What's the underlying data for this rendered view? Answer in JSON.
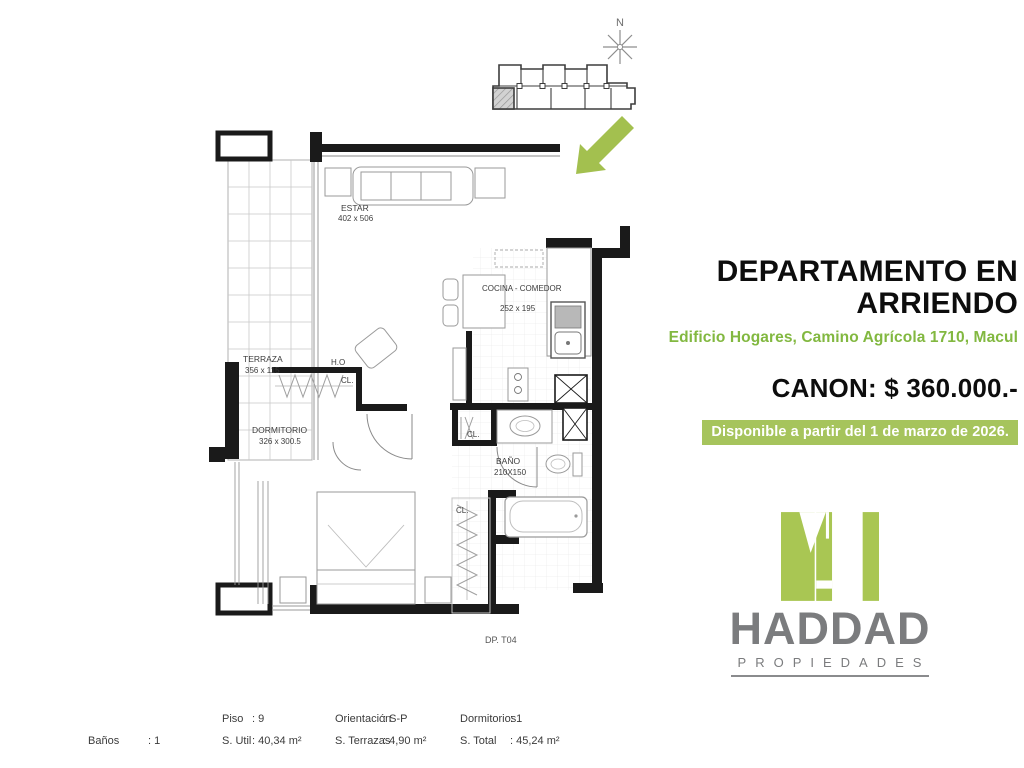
{
  "colors": {
    "accent_green": "#82b840",
    "badge_green": "#a6c45c",
    "arrow_green": "#a3c04f",
    "logo_green": "#a9c653",
    "logo_gray": "#7b7c7e"
  },
  "compass": {
    "north_label": "N"
  },
  "listing": {
    "title_line1": "DEPARTAMENTO EN",
    "title_line2": "ARRIENDO",
    "address": "Edificio Hogares, Camino Agrícola 1710, Macul",
    "price": "CANON: $ 360.000.-",
    "availability": "Disponible a partir del 1 de marzo de 2026."
  },
  "logo": {
    "name": "HADDAD",
    "tagline": "PROPIEDADES"
  },
  "floorplan": {
    "rooms": {
      "estar": {
        "name": "ESTAR",
        "dims": "402 x 506"
      },
      "terraza": {
        "name": "TERRAZA",
        "dims": "356 x 115"
      },
      "dormitorio": {
        "name": "DORMITORIO",
        "dims": "326 x 300.5"
      },
      "cocina": {
        "name": "COCINA - COMEDOR",
        "dims": "252 x 195"
      },
      "bano": {
        "name": "BAÑO",
        "dims": "210X150"
      }
    },
    "labels": {
      "ho": "H.O",
      "closet": "CL.",
      "unit": "DP. T04"
    }
  },
  "specs": {
    "piso": {
      "label": "Piso",
      "value": ": 9"
    },
    "s_util": {
      "label": "S. Util",
      "value": ": 40,34 m²"
    },
    "orientacion": {
      "label": "Orientación",
      "value": ": S-P"
    },
    "s_terrazas": {
      "label": "S. Terrazas",
      "value": ": 4,90 m²"
    },
    "dormitorios": {
      "label": "Dormitorios",
      "value": ": 1"
    },
    "s_total": {
      "label": "S. Total",
      "value": ": 45,24 m²"
    },
    "banos": {
      "label": "Baños",
      "value": ": 1"
    }
  }
}
